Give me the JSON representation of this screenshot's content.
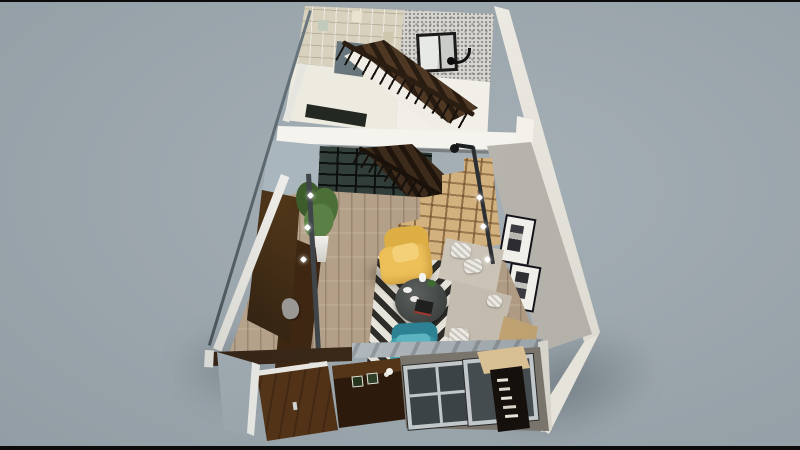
{
  "viewport": {
    "description": "3D cutaway dollhouse render of a two-story loft apartment seen from above at an angle on a gray-blue backdrop",
    "floors": [
      {
        "name": "upper floor",
        "objects": [
          "beige mosaic tiled wall",
          "speckled stone bedroom wall",
          "black framed window",
          "black curved wall lamp",
          "dark wood staircase with black balusters and wood handrail",
          "glass stair landing panel",
          "white cut floor-slab edge",
          "dark floor void opening"
        ]
      },
      {
        "name": "lower floor",
        "objects": [
          "black framed glass partition doors",
          "dark wood stair flight",
          "light wood storage staircase shelving",
          "wood plank flooring",
          "black and white chevron rug",
          "yellow armchair with cushion",
          "round dark coffee table with tea set and books",
          "teal armchair",
          "beige sectional sofa with patterned pillows",
          "gray concrete feature wall",
          "two black framed artworks",
          "black arc floor lamp",
          "wall mounted TV",
          "dark wood TV console with stone sculpture",
          "potted green plant in white planter",
          "dark wood entry door",
          "dark shoe cabinet with mini planters",
          "gray framed front windows",
          "dark bookshelf with white books",
          "light wood side cabinet",
          "cut front wall beam edge",
          "glass corner panels"
        ]
      }
    ]
  },
  "colors": {
    "bg": "#9ba5ac",
    "letterbox": "#0c0c0c",
    "wall_white": "#edeadf",
    "slab_white": "#f5f3ee",
    "tile_beige": "#d8d1bd",
    "speckle_gray": "#d7d5d1",
    "concrete_gray": "#afaca5",
    "wood_floor": "#b29d84",
    "stair_dark": "#3f2d1c",
    "stair_wood_light": "#d2b17e",
    "door_wood": "#46290f",
    "cabinet_dark": "#2c1a0c",
    "accent_yellow": "#eec05a",
    "accent_teal": "#43a3b2",
    "sofa_beige": "#c9c1b4",
    "rug_light": "#e6e3da",
    "rug_dark": "#2e2d29",
    "glass_blue": "#a7b2b8",
    "frame_black": "#1b1b1b",
    "plant_green": "#4c6f38",
    "beam_brown": "#3a2817",
    "beam_gray": "#99a2a8",
    "window_frame": "#c2c7c9",
    "window_glass": "#3c4346",
    "shelf_wood": "#d9bf94",
    "tv_black": "#17110c",
    "pole_dark": "#2c3033",
    "art_white": "#f1efe9"
  }
}
